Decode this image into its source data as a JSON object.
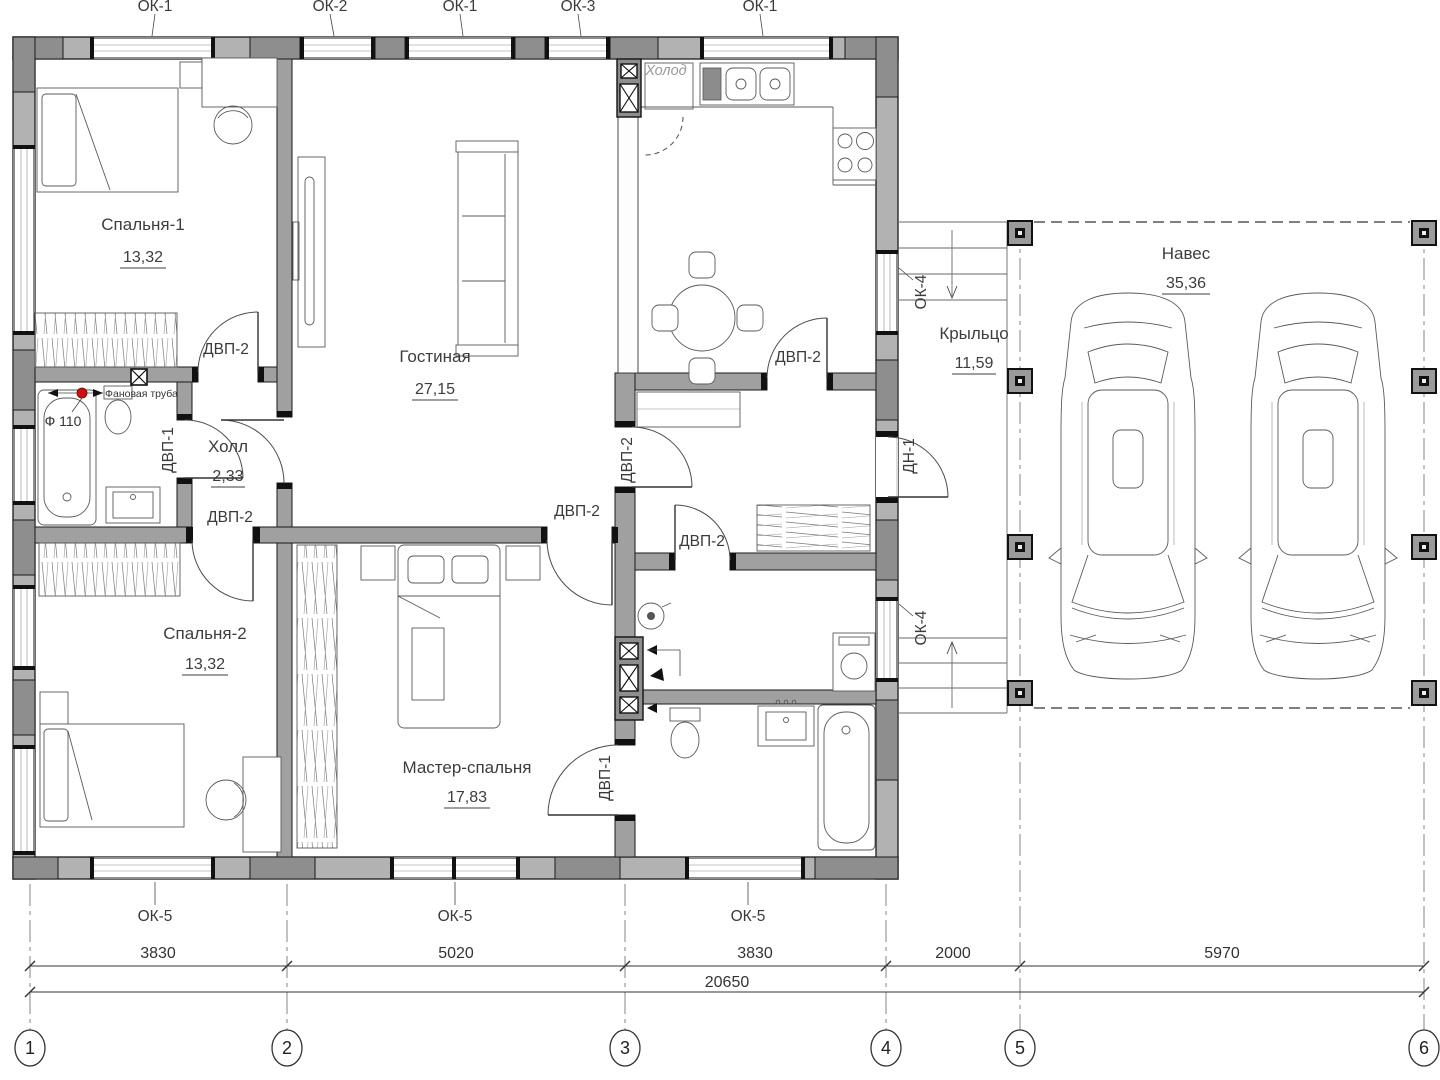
{
  "rooms": {
    "bedroom1": {
      "name": "Спальня-1",
      "area": "13,32"
    },
    "living": {
      "name": "Гостиная",
      "area": "27,15"
    },
    "hall": {
      "name": "Холл",
      "area": "2,33"
    },
    "bedroom2": {
      "name": "Спальня-2",
      "area": "13,32"
    },
    "master": {
      "name": "Мастер-спальня",
      "area": "17,83"
    },
    "porch": {
      "name": "Крыльцо",
      "area": "11,59"
    },
    "carport": {
      "name": "Навес",
      "area": "35,36"
    }
  },
  "window_labels_top": [
    "ОК-1",
    "ОК-2",
    "ОК-1",
    "ОК-3",
    "ОК-1"
  ],
  "window_labels_bottom": [
    "ОК-5",
    "ОК-5",
    "ОК-5"
  ],
  "window_labels_right": [
    "ОК-4",
    "ОК-4"
  ],
  "door_labels": {
    "dvp2": "ДВП-2",
    "dvp1": "ДВП-1",
    "dn1": "ДН-1"
  },
  "annotations": {
    "fridge": "Холод",
    "sewer": "Фановая труба",
    "pipe_diameter": "Ф 110"
  },
  "dimensions": {
    "segments": [
      "3830",
      "5020",
      "3830",
      "2000",
      "5970"
    ],
    "total": "20650"
  },
  "axes": [
    "1",
    "2",
    "3",
    "4",
    "5",
    "6"
  ],
  "colors": {
    "wall": "#b2b2b2",
    "wall_dark": "#8e8e8e",
    "accent_red": "#cc1111"
  }
}
